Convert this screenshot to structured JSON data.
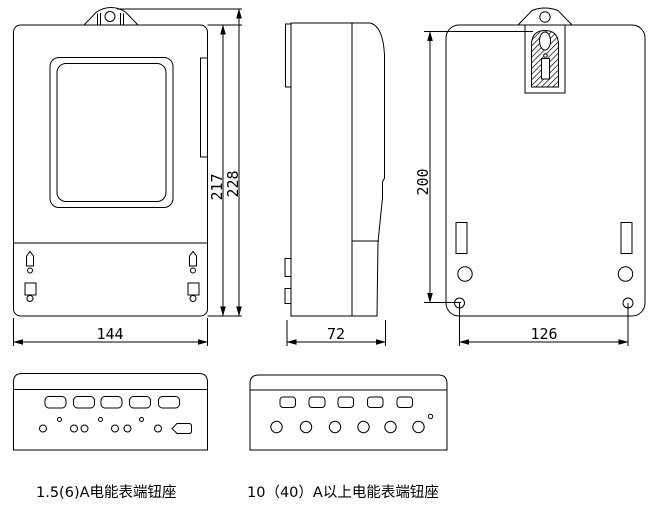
{
  "colors": {
    "line": "#000000",
    "background": "#ffffff"
  },
  "views": {
    "front": {
      "dims": {
        "width": "144",
        "body_height": "217",
        "overall_height": "228"
      }
    },
    "side": {
      "dims": {
        "depth": "72"
      }
    },
    "back": {
      "dims": {
        "hanger_to_mount_holes": "200",
        "mount_hole_spacing": "126"
      }
    }
  },
  "terminal_blocks": [
    {
      "caption": "1.5(6)A电能表端钮座"
    },
    {
      "caption": "10（40）A以上电能表端钮座"
    }
  ]
}
